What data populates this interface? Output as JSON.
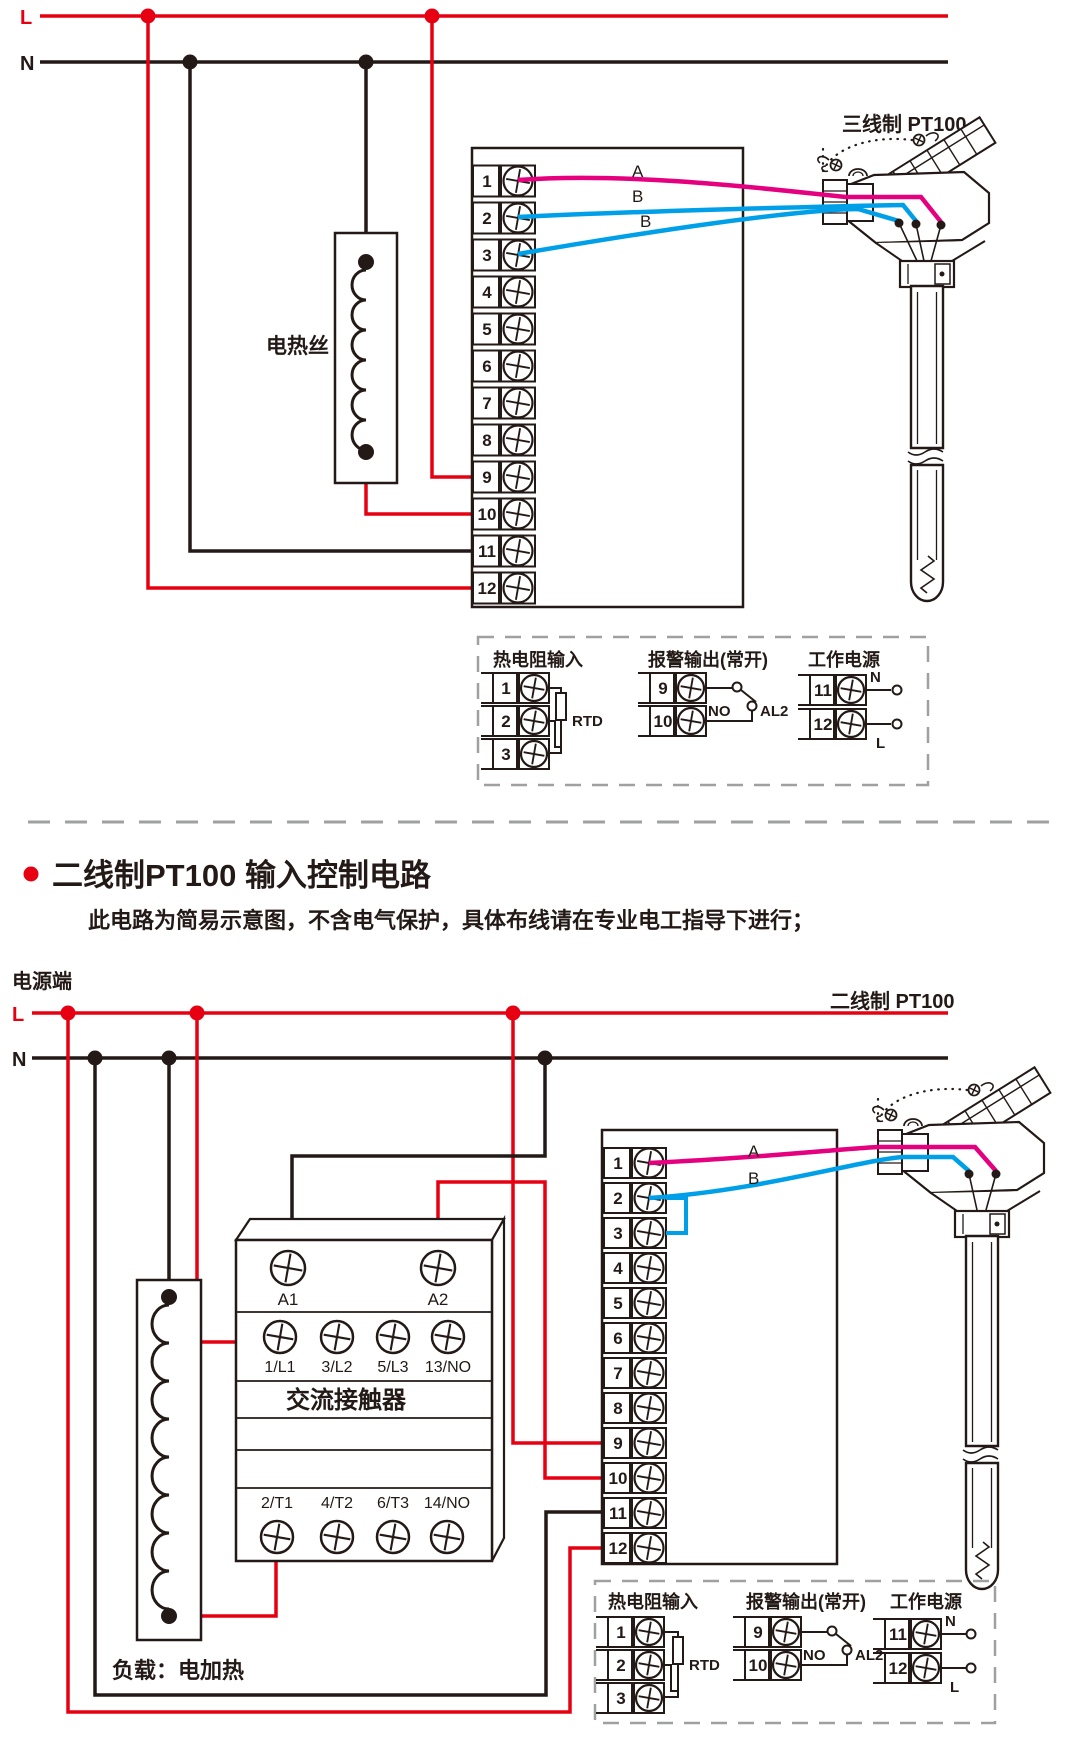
{
  "colors": {
    "wire_live": "#e60012",
    "wire_neutral": "#231916",
    "wire_sensor_a": "#e4007f",
    "wire_sensor_b": "#00a0e9",
    "panel_dash": "#9fa0a0"
  },
  "power": {
    "live_label": "L",
    "neutral_label": "N"
  },
  "terminals": [
    "1",
    "2",
    "3",
    "4",
    "5",
    "6",
    "7",
    "8",
    "9",
    "10",
    "11",
    "12"
  ],
  "top_circuit": {
    "heater_label": "电热丝",
    "sensor_label": "三线制 PT100",
    "wire_a_label": "A",
    "wire_b1_label": "B",
    "wire_b2_label": "B"
  },
  "detail_panel": {
    "rtd_title": "热电阻输入",
    "rtd_label": "RTD",
    "alarm_title": "报警输出(常开)",
    "alarm_no_label": "NO",
    "alarm_relay_label": "AL2",
    "supply_title": "工作电源",
    "supply_n_label": "N",
    "supply_l_label": "L"
  },
  "section2": {
    "title": "二线制PT100 输入控制电路",
    "note": "此电路为简易示意图，不含电气保护，具体布线请在专业电工指导下进行；",
    "power_terminal_label": "电源端",
    "sensor_label": "二线制 PT100",
    "wire_a_label": "A",
    "wire_b_label": "B",
    "load_label": "负载：电加热",
    "contactor": {
      "a1": "A1",
      "a2": "A2",
      "top_row": [
        "1/L1",
        "3/L2",
        "5/L3",
        "13/NO"
      ],
      "name": "交流接触器",
      "bottom_row": [
        "2/T1",
        "4/T2",
        "6/T3",
        "14/NO"
      ]
    }
  }
}
